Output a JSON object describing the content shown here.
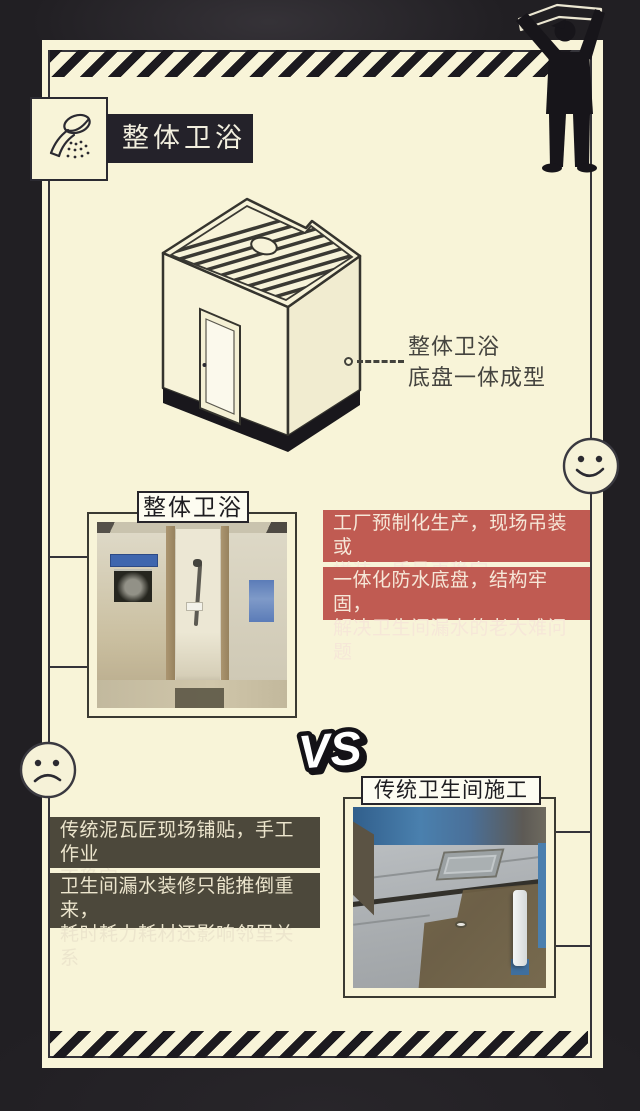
{
  "poster": {
    "header": {
      "title": "整体卫浴"
    },
    "diagram": {
      "callout": {
        "line1": "整体卫浴",
        "line2": "底盘一体成型"
      }
    },
    "modern_section": {
      "photo_label": "整体卫浴",
      "mood": "happy",
      "benefits": [
        {
          "lines": [
            "工厂预制化生产，现场吊装或",
            "拼装，质量更稳定"
          ]
        },
        {
          "lines": [
            "一体化防水底盘，结构牢固，",
            "解决卫生间漏水的老大难问题"
          ]
        }
      ]
    },
    "vs_label": "VS",
    "traditional_section": {
      "photo_label": "传统卫生间施工",
      "mood": "sad",
      "drawbacks": [
        {
          "lines": [
            "传统泥瓦匠现场铺贴，手工作业",
            "不稳定"
          ]
        },
        {
          "lines": [
            "卫生间漏水装修只能推倒重来，",
            "耗时耗力耗材还影响邻里关系"
          ]
        }
      ]
    },
    "colors": {
      "background": "#211f23",
      "panel": "#f8f4d8",
      "ink": "#2b2a31",
      "benefit_red": "#c05b52",
      "drawback_olive": "#4c483b",
      "label_bg": "#fdfcf1"
    }
  }
}
